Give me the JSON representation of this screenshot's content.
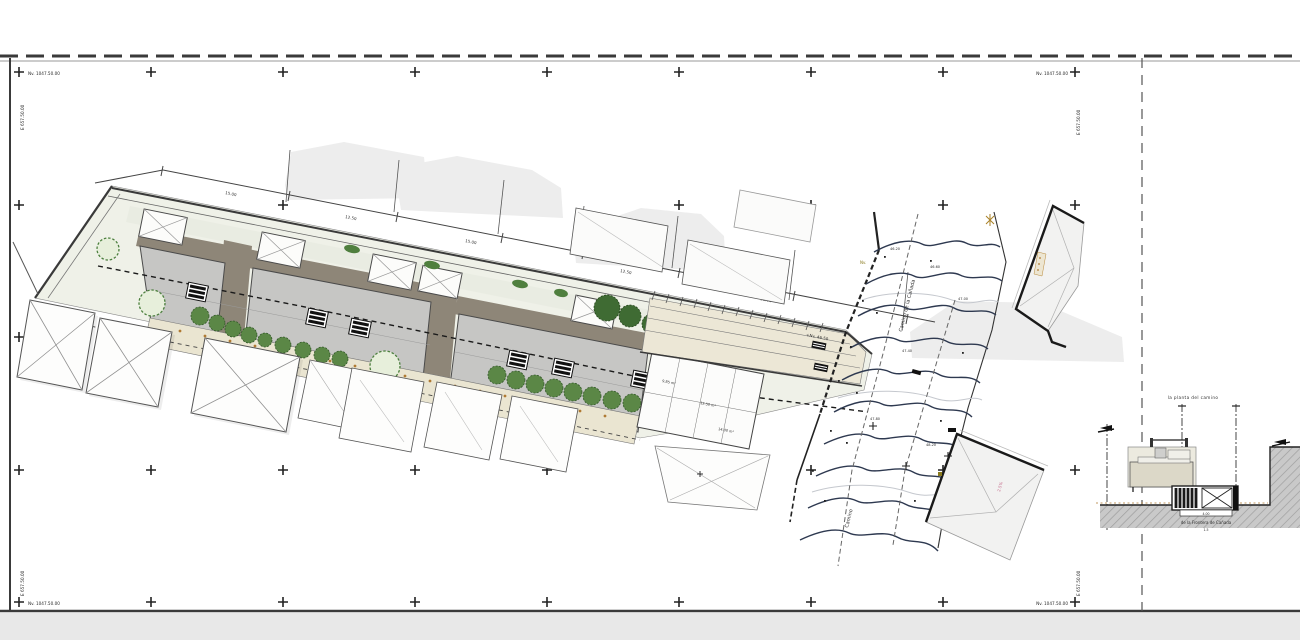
{
  "sheet": {
    "corner_level_label": "Nv. 1047.50.00",
    "corner_grid_label": "E 657.50.00"
  },
  "plan": {
    "dim_labels": [
      "15.00",
      "12.50",
      "15.00",
      "12.50",
      "18.00"
    ],
    "corridor_level_label": "+Nv. 46.50",
    "camino_label": "Camino de la Cañada",
    "camino_label_2": "Camino",
    "area_labels": [
      "9.85 m²",
      "12.50 m²",
      "14.00 m²"
    ],
    "contour_labels": [
      "46.20",
      "46.60",
      "47.00",
      "47.40",
      "47.80",
      "48.20"
    ],
    "slope_label": "2.5%",
    "marker_label": "Nv."
  },
  "section": {
    "title": "la planta del camino",
    "ground_label": "de la Frontera de Cañada",
    "scale_label": "1.5",
    "channel_width_label": "4.00"
  },
  "grid": {
    "cols": [
      19,
      151,
      283,
      415,
      547,
      679,
      811,
      943,
      1075
    ],
    "rows": [
      72,
      205,
      337,
      470,
      602
    ]
  },
  "colors": {
    "paper": "#ffffff",
    "margin": "#e9e9e9",
    "ink": "#3a3a3a",
    "roof": "#c6c6c4",
    "band": "#8e8678",
    "walk": "#eae5d1",
    "ground": "#eff1e8",
    "mass": "#ededed",
    "tree": "#4b7f3d",
    "contour": "#2e3950",
    "accent_orange": "#b07a33"
  }
}
